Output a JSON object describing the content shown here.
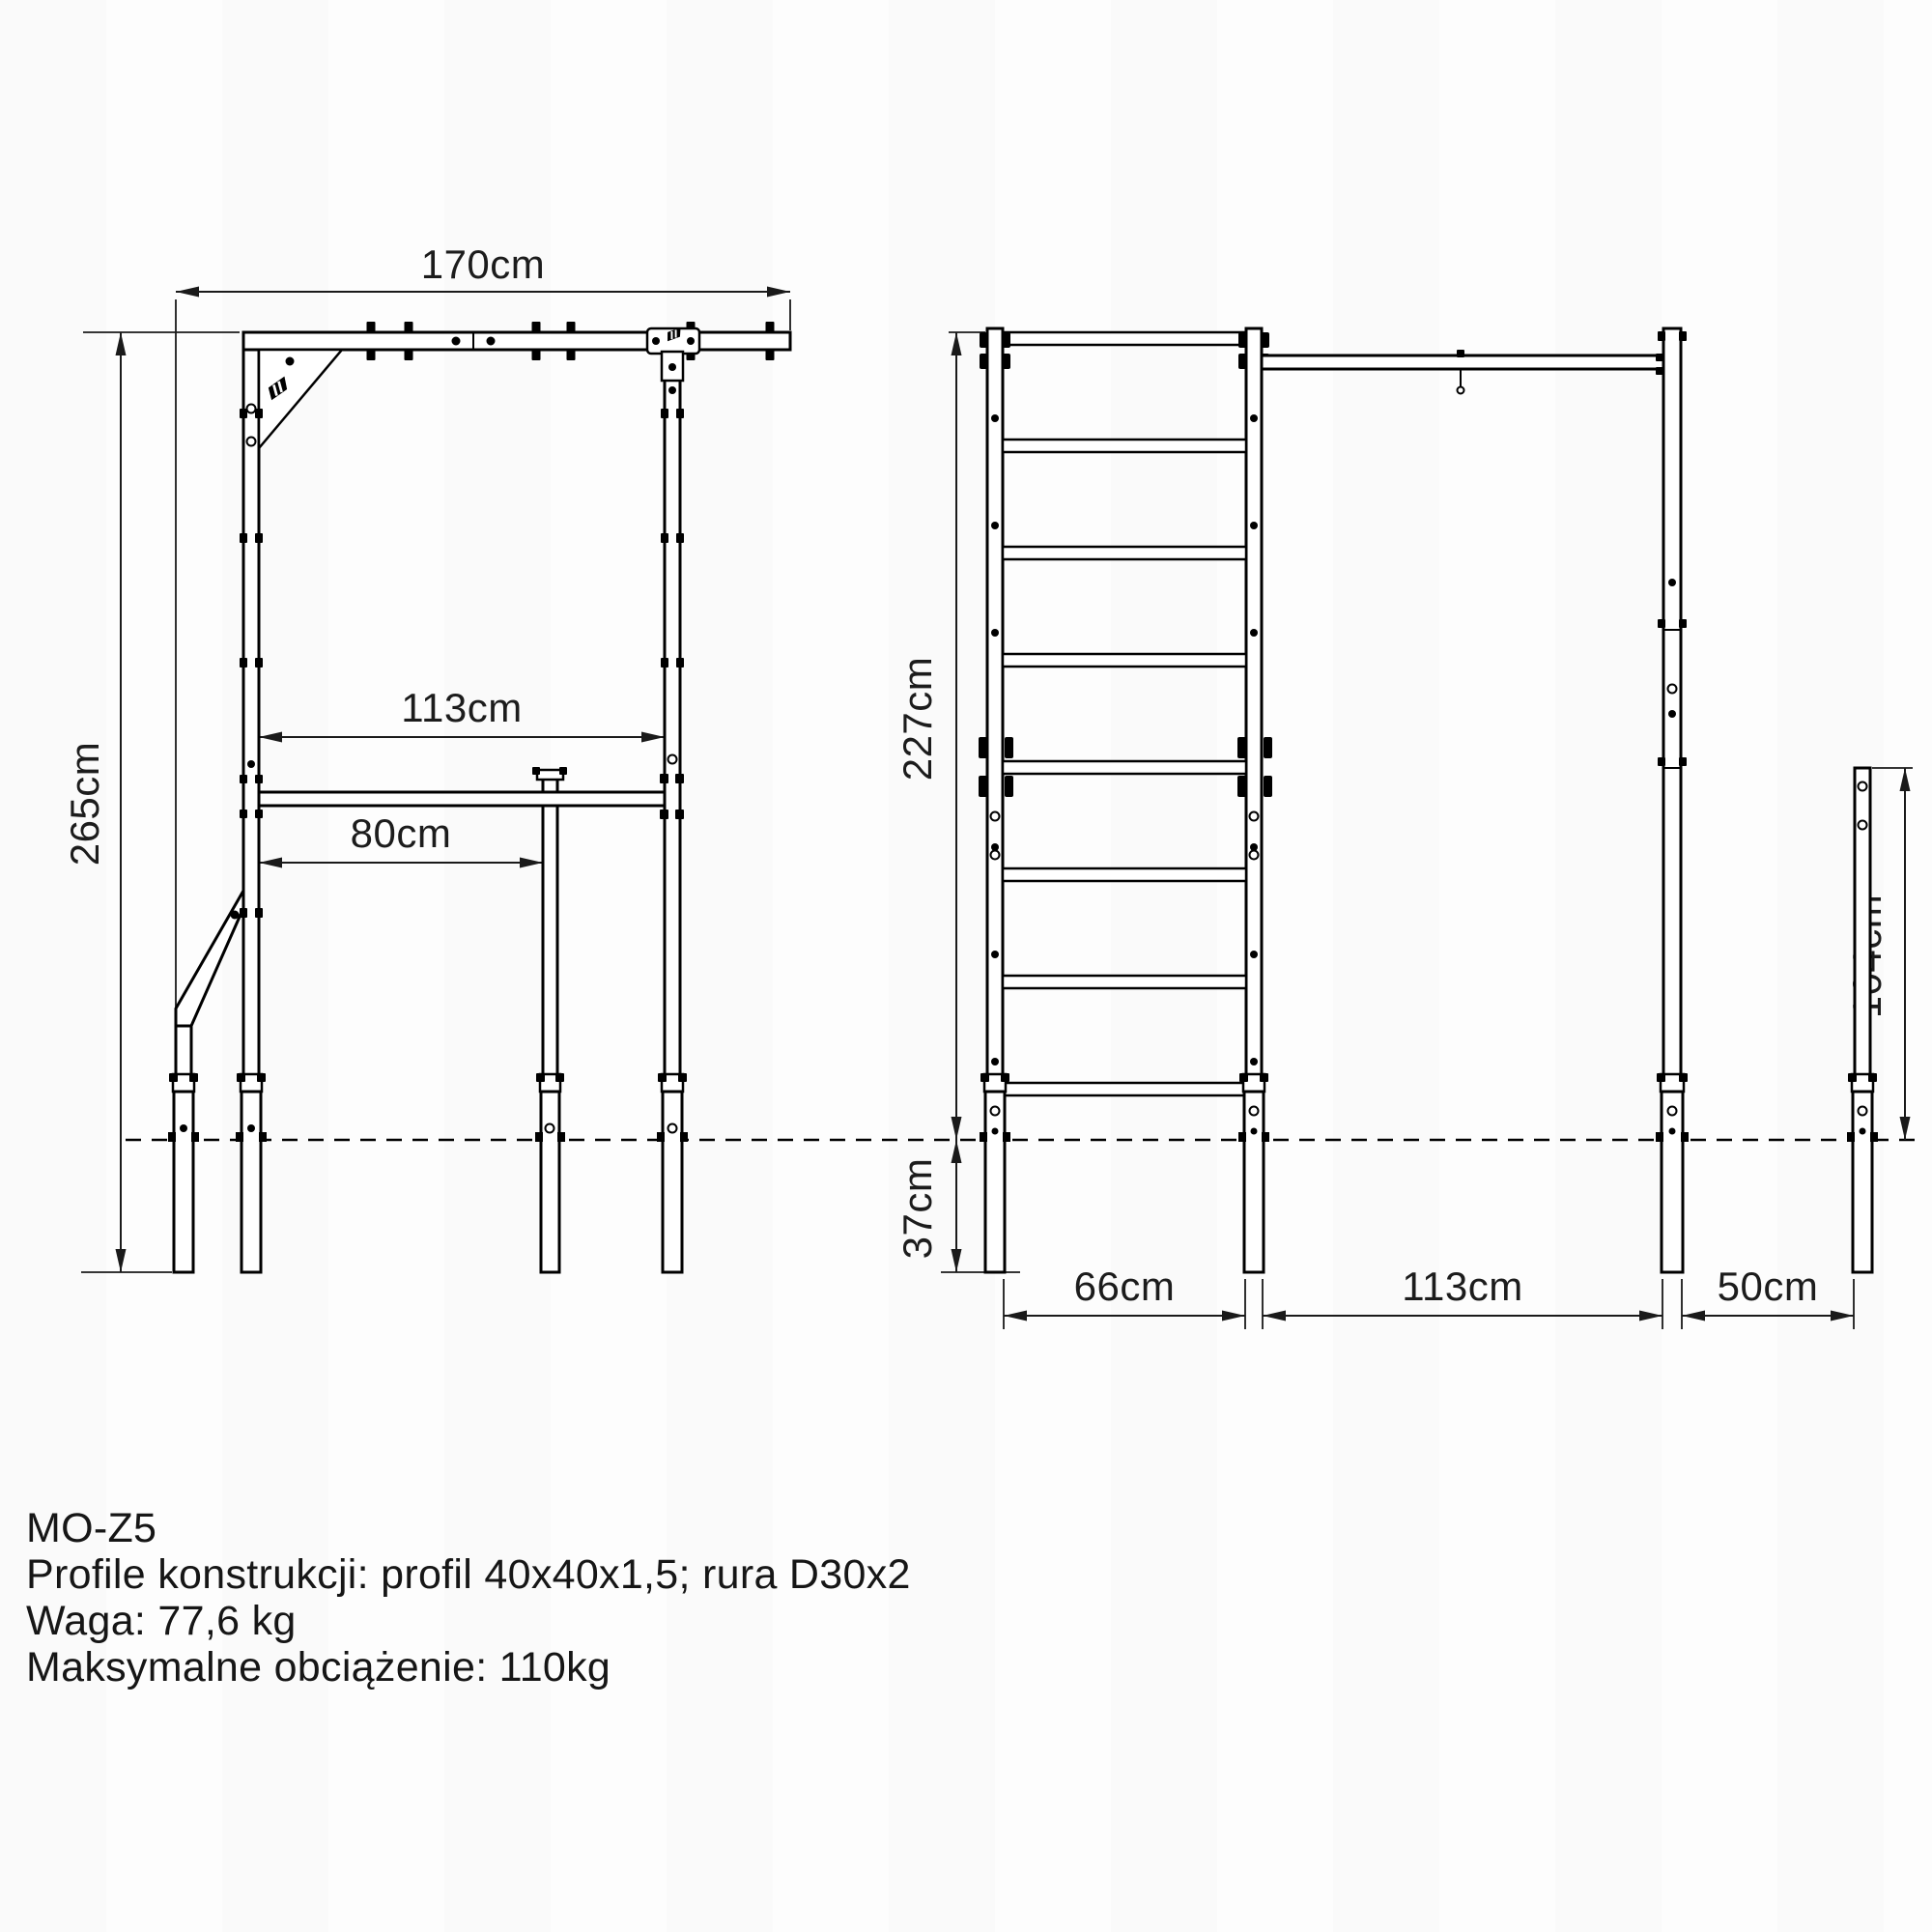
{
  "document": {
    "type": "technical-drawing",
    "views": [
      "front-view",
      "side-view"
    ],
    "background_color": "#fdfdfd",
    "line_color": "#000000"
  },
  "front": {
    "dim_total_width": "170cm",
    "dim_total_height": "265cm",
    "dim_inner_span": "113cm",
    "dim_dip_bar_width": "80cm"
  },
  "side": {
    "dim_height_above_ground": "227cm",
    "dim_depth_below_ground": "37cm",
    "dim_ladder_depth": "66cm",
    "dim_frame_depth": "113cm",
    "dim_rear_post_offset": "50cm",
    "dim_rear_post_height": "104cm"
  },
  "specs": {
    "model": "MO-Z5",
    "profiles": "Profile konstrukcji: profil 40x40x1,5; rura D30x2",
    "weight": "Waga: 77,6 kg",
    "max_load": "Maksymalne obciążenie: 110kg"
  },
  "icons": {
    "brand_logo": "diagonal-striped-manufacturer-mark"
  }
}
